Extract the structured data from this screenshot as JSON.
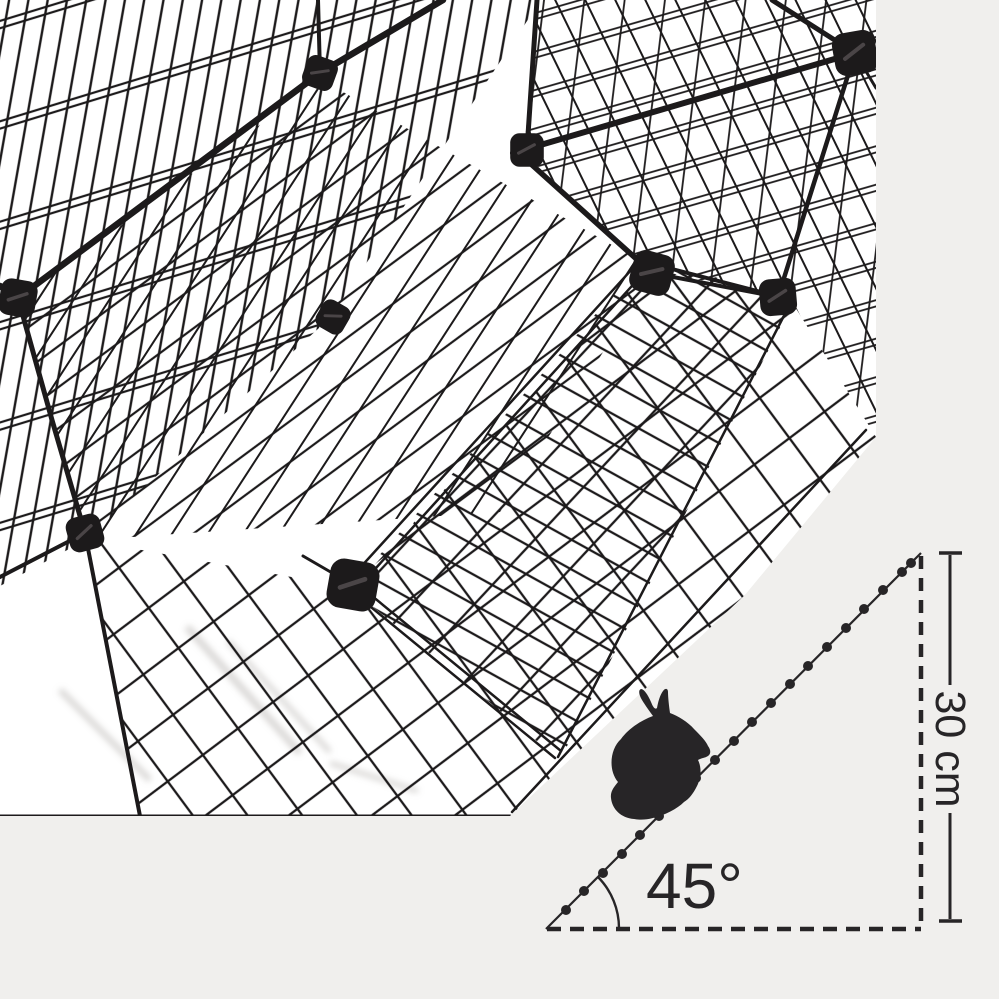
{
  "image": {
    "subject": "black wire-grid pet playpen with upper level and mesh ramp",
    "colors": {
      "canvas": "#f0efed",
      "photo_bg": "#ffffff",
      "wire": "#1c1a1b",
      "ink": "#272527",
      "shadow": "#b9b6b3"
    }
  },
  "diagram": {
    "angle_label": "45°",
    "height_label": "30 cm",
    "angle_value_deg": 45,
    "height_value_cm": 30
  }
}
